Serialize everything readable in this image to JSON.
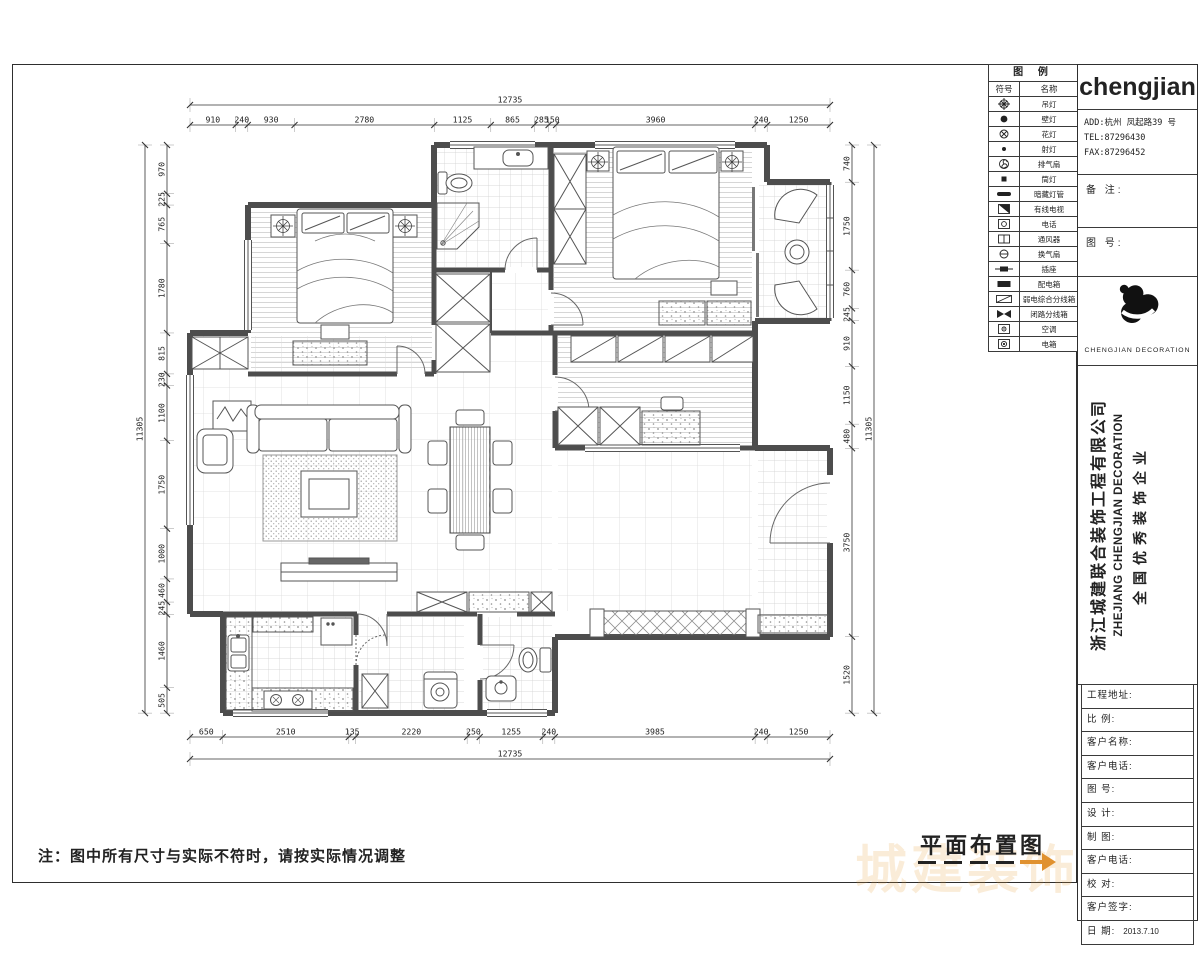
{
  "sheet": {
    "note": "注：图中所有尺寸与实际不符时，请按实际情况调整",
    "drawing_title": "平面布置图"
  },
  "legend": {
    "title": "图  例",
    "col_symbol": "符号",
    "col_name": "名称",
    "items": [
      {
        "symbol": "ceiling-lamp-icon",
        "name": "吊灯"
      },
      {
        "symbol": "wall-lamp-icon",
        "name": "壁灯"
      },
      {
        "symbol": "flower-lamp-icon",
        "name": "花灯"
      },
      {
        "symbol": "spot-lamp-icon",
        "name": "射灯"
      },
      {
        "symbol": "exhaust-fan-icon",
        "name": "排气扇"
      },
      {
        "symbol": "down-lamp-icon",
        "name": "筒灯"
      },
      {
        "symbol": "cove-light-icon",
        "name": "暗藏灯管"
      },
      {
        "symbol": "cable-tv-icon",
        "name": "有线电视"
      },
      {
        "symbol": "phone-icon",
        "name": "电话"
      },
      {
        "symbol": "vent-icon",
        "name": "通风器"
      },
      {
        "symbol": "heater-icon",
        "name": "换气扇"
      },
      {
        "symbol": "socket-icon",
        "name": "插座"
      },
      {
        "symbol": "dist-box-icon",
        "name": "配电箱"
      },
      {
        "symbol": "weak-box-icon",
        "name": "弱电综合分线箱"
      },
      {
        "symbol": "cctv-box-icon",
        "name": "闭路分线箱"
      },
      {
        "symbol": "ac-icon",
        "name": "空调"
      },
      {
        "symbol": "meter-box-icon",
        "name": "电箱"
      }
    ]
  },
  "company": {
    "logo_text": "chengjian",
    "address": "ADD:杭州 凤起路39 号",
    "tel": "TEL:87296430",
    "fax": "FAX:87296452",
    "remark_label": "备  注:",
    "drawing_no_label": "图  号:",
    "logo_caption": "CHENGJIAN  DECORATION",
    "name_cn": "浙江城建联合装饰工程有限公司",
    "name_en": "ZHEJIANG CHENGJIAN DECORATION",
    "slogan": "全国优秀装饰企业",
    "watermark_text": "城建装饰"
  },
  "title_block": {
    "fields": [
      "工程地址:",
      "比   例:",
      "客户名称:",
      "客户电话:",
      "图   号:",
      "设   计:",
      "制   图:",
      "客户电话:",
      "校   对:",
      "客户签字:"
    ],
    "date_label": "日   期:",
    "date_value": "2013.7.10"
  },
  "dimensions": {
    "top": {
      "total": 12735,
      "segments": [
        910,
        240,
        930,
        2780,
        1125,
        865,
        285,
        150,
        3960,
        240,
        1250
      ]
    },
    "bottom": {
      "total": 12735,
      "segments": [
        650,
        2510,
        135,
        2220,
        250,
        1255,
        240,
        3985,
        240,
        1250
      ]
    },
    "left": {
      "total": 11305,
      "segments": [
        970,
        225,
        765,
        1780,
        815,
        230,
        1100,
        1750,
        1000,
        460,
        245,
        1460,
        505
      ]
    },
    "right": {
      "total": 11305,
      "segments": [
        740,
        1750,
        760,
        245,
        910,
        1150,
        480,
        3750,
        1520
      ]
    }
  }
}
